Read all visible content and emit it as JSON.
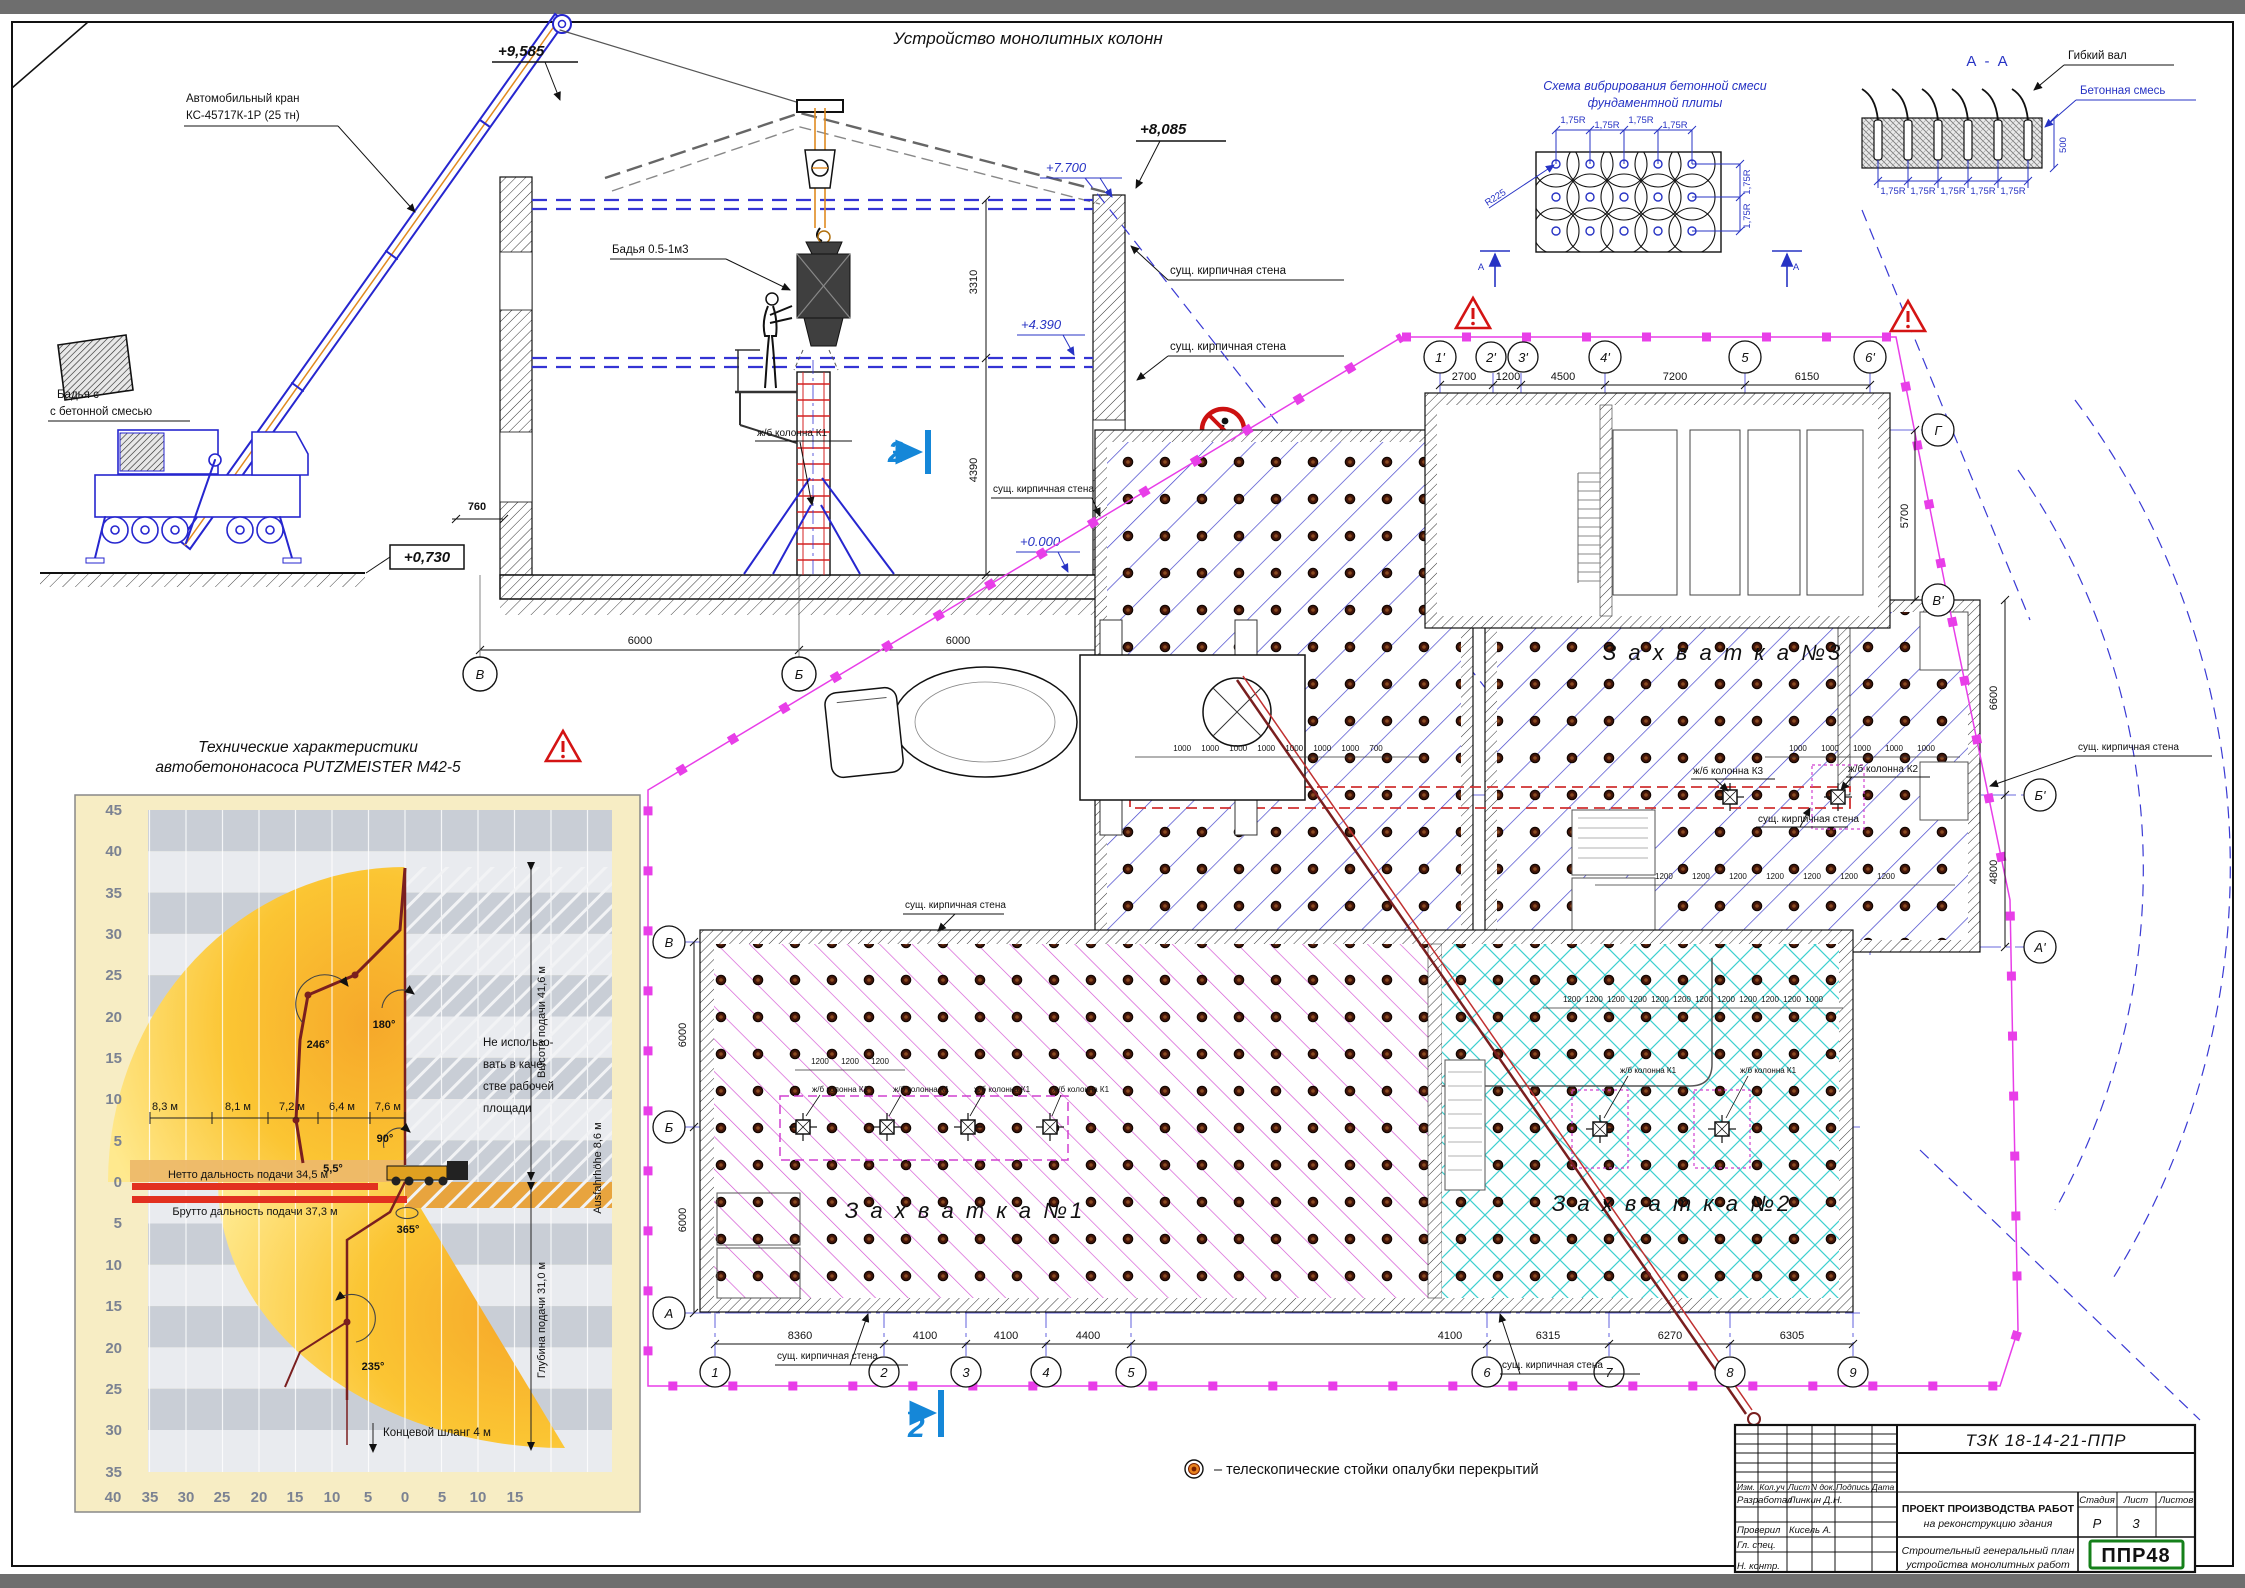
{
  "titles": {
    "main": "Устройство монолитных колонн",
    "vib1": "Схема вибрирования бетонной смеси",
    "vib2": "фундаментной плиты",
    "aa": "А - А",
    "pump1": "Технические характеристики",
    "pump2": "автобетононасоса PUTZMEISTER M42-5"
  },
  "legend": {
    "text": "–  телескопические стойки опалубки перекрытий"
  },
  "sec": {
    "crane1": "Автомобильный кран",
    "crane2": "КС-45717К-1Р (25 тн)",
    "bucketGnd1": "Бадья с",
    "bucketGnd2": "с бетонной смесью",
    "bucket": "Бадья 0.5-1м3",
    "colK1": "ж/б колонна К1",
    "wall": "сущ. кирпичная стена",
    "lv9585": "+9,585",
    "lv8085": "+8,085",
    "lv7700": "+7.700",
    "lv4390": "+4.390",
    "lv0000": "+0.000",
    "lvm0230": "-0,230",
    "lv0730": "+0,730",
    "d3310": "3310",
    "d4390": "4390",
    "d760": "760",
    "d6000": "6000",
    "axes": [
      "В",
      "Б",
      "А"
    ]
  },
  "vib": {
    "r175": "1,75R",
    "r225": "R225",
    "axA": "А"
  },
  "aa": {
    "shaft": "Гибкий вал",
    "mix": "Бетонная смесь",
    "d500": "500",
    "r175": "1,75R"
  },
  "plan": {
    "z1": "З а х в а т к а  №1",
    "z2": "З а х в а т к а  №2",
    "z3": "З а х в а т к а  №3",
    "colK1": "ж/б колонна К1",
    "colK2": "ж/б колонна К2",
    "colK3": "ж/б колонна К3",
    "wall": "сущ. кирпичная стена",
    "cut": "2",
    "axesTop": [
      "1'",
      "2'",
      "3'",
      "4'",
      "5",
      "6'"
    ],
    "dimsTop": [
      "2700",
      "1200",
      "4500",
      "7200",
      "6150"
    ],
    "axesRight": [
      "Г",
      "В'",
      "Б'",
      "А'"
    ],
    "dimsRight": [
      "5700",
      "6600",
      "4800"
    ],
    "axesLeft": [
      "В",
      "Б",
      "А"
    ],
    "dimLeft": "6000",
    "axesBottom": [
      "1",
      "2",
      "3",
      "4",
      "5",
      "6",
      "7",
      "8",
      "9"
    ],
    "dimsBottom": [
      "8360",
      "4100",
      "4100",
      "4400",
      "4100",
      "6315",
      "6270",
      "6305"
    ],
    "chainA": "1000 1000 1000 1000 1000 1000 1000 700",
    "chainB": "1000 1000 1000 1000 1000",
    "chainC": "1200 1200 1200 1200 1200 1200 1200",
    "chainD": "1200 1200 1200 1200 1200 1200 1200 1200 1200 1200 1200 1000",
    "chainE": "1200 1200 1200"
  },
  "pump": {
    "yA": [
      "45",
      "40",
      "35",
      "30",
      "25",
      "20",
      "15",
      "10",
      "5"
    ],
    "zero": "0",
    "yB": [
      "5",
      "10",
      "15",
      "20",
      "25",
      "30",
      "35"
    ],
    "xL": [
      "40",
      "35",
      "30",
      "25",
      "20",
      "15",
      "10",
      "5"
    ],
    "xR": [
      "5",
      "10",
      "15"
    ],
    "reach": [
      "8,3 м",
      "8,1 м",
      "7,2 м",
      "6,4 м",
      "7,6 м"
    ],
    "a246": "246°",
    "a180": "180°",
    "a90": "90°",
    "a55": "5,5°",
    "a365": "365°",
    "a235": "235°",
    "nu1": "Не использо-",
    "nu2": "вать в каче-",
    "nu3": "стве рабочей",
    "nu4": "площади",
    "netto": "Нетто дальность подачи 34,5 м",
    "brutto": "Брутто дальность подачи 37,3 м",
    "hose": "Концевой шланг 4 м",
    "height": "Высота подачи 41,6 м",
    "depth": "Глубина подачи 31,0 м",
    "ausfahr": "Ausfahrhöhe 8,6 м"
  },
  "tb": {
    "doc": "ТЗК 18-14-21-ППР",
    "cols": [
      "Изм.",
      "Кол.уч",
      "Лист",
      "N док.",
      "Подпись",
      "Дата"
    ],
    "r1l": "Разработал",
    "r1v": "Линкин Д.Н.",
    "r2l": "Проверил",
    "r2v": "Кисель А.",
    "r3l": "Гл. спец.",
    "r4l": "Н. контр.",
    "p1": "ПРОЕКТ ПРОИЗВОДСТВА РАБОТ",
    "p2": "на реконструкцию здания",
    "s1": "Стадия",
    "s2": "Лист",
    "s3": "Листов",
    "stage": "Р",
    "sheet": "3",
    "t1": "Строительный генеральный план",
    "t2": "устройства монолитных работ",
    "logo": "ППР48"
  }
}
